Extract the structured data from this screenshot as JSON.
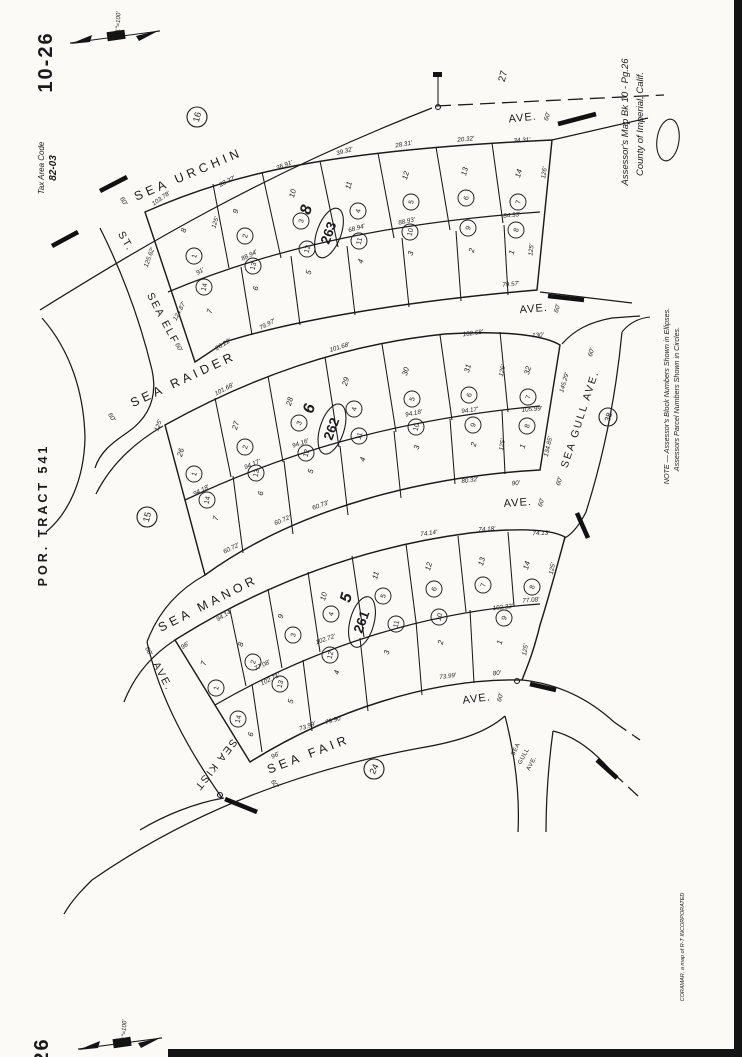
{
  "sheet": {
    "number": "10-26",
    "number_bottom": "10-26",
    "scale": "1\"=100'",
    "tax_area_code_label": "Tax Area Code",
    "tax_area_code": "82-03",
    "por_tract": "POR.  TRACT  541"
  },
  "margin": {
    "assessor_line1": "Assessor's  Map  Bk 10 - Pg.26",
    "assessor_line2": "County  of  Imperial,  Calif.",
    "note_line1": "NOTE — Assessor's  Block  Numbers  Shown  in  Ellipses.",
    "note_line2": "Assessors  Parcel  Numbers  Shown  in  Circles.",
    "credit": "CORAMAR, a map of R-T INCORPORATED"
  },
  "streets": {
    "sea_urchin": "SEA  URCHIN",
    "st": "ST.",
    "sea_elf": "SEA ELF",
    "sea_raider": "SEA  RAIDER",
    "sea_manor": "SEA  MANOR",
    "sea_fair": "SEA  FAIR",
    "sea_kist": "SEA KIST",
    "sea_kist_ave": "AVE.",
    "sea_gull": "SEA  GULL  AVE.",
    "sea_gull_small": [
      "SEA",
      "GULL",
      "AVE."
    ],
    "ave": "AVE.",
    "sixty": "60'"
  },
  "refs": {
    "c16": "16",
    "c27": "27",
    "c15": "15",
    "c38": "38",
    "c24": "24"
  },
  "blocks": [
    {
      "number": "8",
      "ellipse": "263",
      "top": [
        {
          "lot": "8",
          "p": "1"
        },
        {
          "lot": "9",
          "p": "2"
        },
        {
          "lot": "10",
          "p": "3"
        },
        {
          "lot": "11",
          "p": "4"
        },
        {
          "lot": "12",
          "p": "5"
        },
        {
          "lot": "13",
          "p": "6"
        },
        {
          "lot": "14",
          "p": "7"
        }
      ],
      "bottom": [
        {
          "lot": "7",
          "p": "14"
        },
        {
          "lot": "6",
          "p": "13"
        },
        {
          "lot": "5",
          "p": "12"
        },
        {
          "lot": "4",
          "p": "11"
        },
        {
          "lot": "3",
          "p": "10"
        },
        {
          "lot": "2",
          "p": "9"
        },
        {
          "lot": "1",
          "p": "8"
        }
      ],
      "dims": [
        "103.78'",
        "28.32'",
        "36.91'",
        "39.32'",
        "28.31'",
        "20.32'",
        "34.31'",
        "126'",
        "125'",
        "79.57'",
        "84.33'",
        "88.93'",
        "68.94'",
        "88.94'",
        "91'",
        "125.62'",
        "26.22'",
        "79.97'",
        "124.87'",
        "125'"
      ]
    },
    {
      "number": "6",
      "ellipse": "262",
      "top": [
        {
          "lot": "26",
          "p": "1"
        },
        {
          "lot": "27",
          "p": "2"
        },
        {
          "lot": "28",
          "p": "3"
        },
        {
          "lot": "29",
          "p": "4"
        },
        {
          "lot": "30",
          "p": "5"
        },
        {
          "lot": "31",
          "p": "6"
        },
        {
          "lot": "32",
          "p": "7"
        }
      ],
      "bottom": [
        {
          "lot": "7",
          "p": "14"
        },
        {
          "lot": "6",
          "p": "13"
        },
        {
          "lot": "5",
          "p": "12"
        },
        {
          "lot": "4",
          "p": "11"
        },
        {
          "lot": "3",
          "p": "10"
        },
        {
          "lot": "2",
          "p": "9"
        },
        {
          "lot": "1",
          "p": "8"
        }
      ],
      "dims": [
        "125'",
        "101.68'",
        "101.68'",
        "102.68'",
        "130'",
        "126'",
        "125'",
        "145.29'",
        "134.85'",
        "105.99'",
        "94.17'",
        "94.18'",
        "94.16'",
        "94.17'",
        "94.18'",
        "60.72'",
        "60.73'",
        "80.32'",
        "90'",
        "60.72'"
      ]
    },
    {
      "number": "5",
      "ellipse": "261",
      "top": [
        {
          "lot": "7",
          "p": "1"
        },
        {
          "lot": "8",
          "p": "2"
        },
        {
          "lot": "9",
          "p": "3"
        },
        {
          "lot": "10",
          "p": "4"
        },
        {
          "lot": "11",
          "p": "5"
        },
        {
          "lot": "12",
          "p": "6"
        },
        {
          "lot": "13",
          "p": "7"
        },
        {
          "lot": "14",
          "p": "8"
        }
      ],
      "bottom": [
        {
          "lot": "6",
          "p": "14"
        },
        {
          "lot": "5",
          "p": "13"
        },
        {
          "lot": "4",
          "p": "12"
        },
        {
          "lot": "3",
          "p": "11"
        },
        {
          "lot": "2",
          "p": "10"
        },
        {
          "lot": "1",
          "p": "9"
        }
      ],
      "dims": [
        "96'",
        "94.14'",
        "74.14'",
        "74.18'",
        "74.13'",
        "125'",
        "77.08'",
        "102.32'",
        "125'",
        "77.08'",
        "102.71'",
        "102.72'",
        "79.90'",
        "73.99'",
        "80'",
        "96'",
        "73.99'"
      ]
    }
  ]
}
